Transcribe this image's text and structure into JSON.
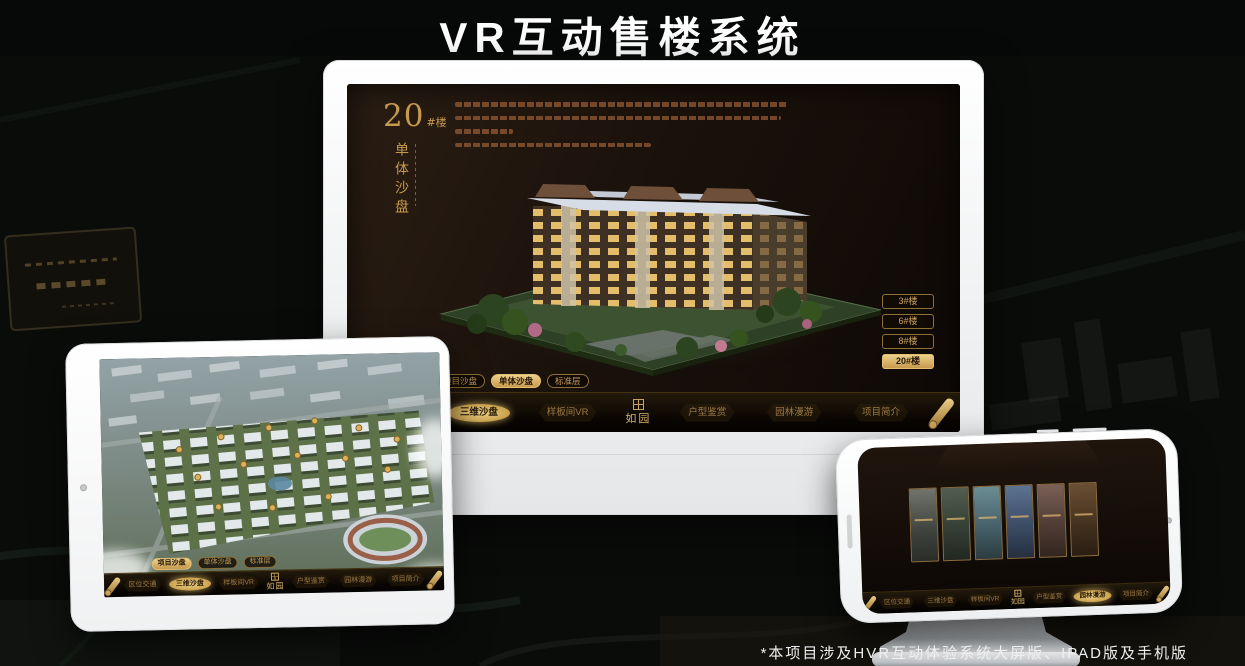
{
  "title": "VR互动售楼系统",
  "footnote": "*本项目涉及HVR互动体验系统大屏版、IPAD版及手机版",
  "colors": {
    "gold": "#cfa45f",
    "gold_bright": "#e8c87d",
    "selected_text": "#241504",
    "screen_dark": "#150d07",
    "background": "#0a0c0a"
  },
  "menu": {
    "logo": "如园",
    "items": [
      "区位交通",
      "三维沙盘",
      "样板间VR",
      "户型鉴赏",
      "园林漫游",
      "项目简介"
    ]
  },
  "desktop": {
    "heading_number": "20",
    "heading_unit": "#楼",
    "heading_subtitle": "单体沙盘",
    "floor_buttons": [
      "3#楼",
      "6#楼",
      "8#楼",
      "20#楼"
    ],
    "selected_floor": "20#楼",
    "sub_tabs": [
      "项目沙盘",
      "单体沙盘",
      "标准层"
    ],
    "selected_sub_tab": "单体沙盘",
    "selected_menu": "三维沙盘"
  },
  "tablet": {
    "sub_tabs": [
      "项目沙盘",
      "单体沙盘",
      "标准层"
    ],
    "selected_sub_tab": "项目沙盘",
    "selected_menu": "三维沙盘"
  },
  "phone": {
    "selected_menu": "园林漫游"
  }
}
